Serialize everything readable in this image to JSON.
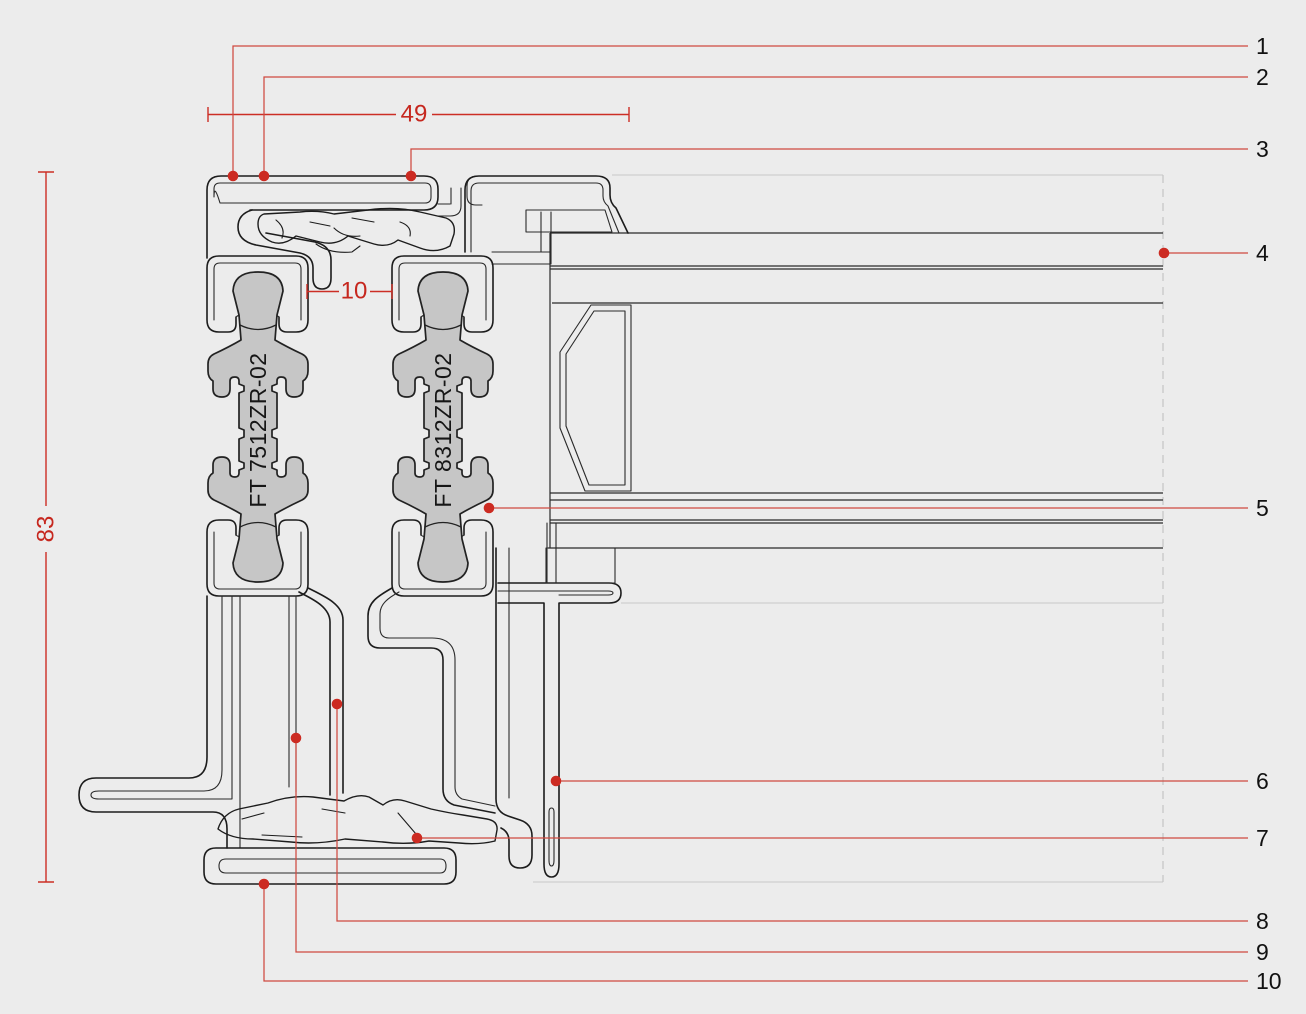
{
  "drawing": {
    "type": "aluminium-profile-cross-section",
    "profiles": [
      {
        "label": "FT 7512ZR-02"
      },
      {
        "label": "FT 8312ZR-02"
      }
    ],
    "dimensions": {
      "overall_width": "49",
      "gap": "10",
      "overall_height": "83"
    },
    "callouts": [
      {
        "number": "1"
      },
      {
        "number": "2"
      },
      {
        "number": "3"
      },
      {
        "number": "4"
      },
      {
        "number": "5"
      },
      {
        "number": "6"
      },
      {
        "number": "7"
      },
      {
        "number": "8"
      },
      {
        "number": "9"
      },
      {
        "number": "10"
      }
    ],
    "colors": {
      "background": "#ececec",
      "outline": "#1c1c1c",
      "thermal_break_fill": "#c6c6c6",
      "annotation_red": "#cc2e25",
      "light_line": "#c9c9c9",
      "callout_text": "#111111"
    }
  }
}
